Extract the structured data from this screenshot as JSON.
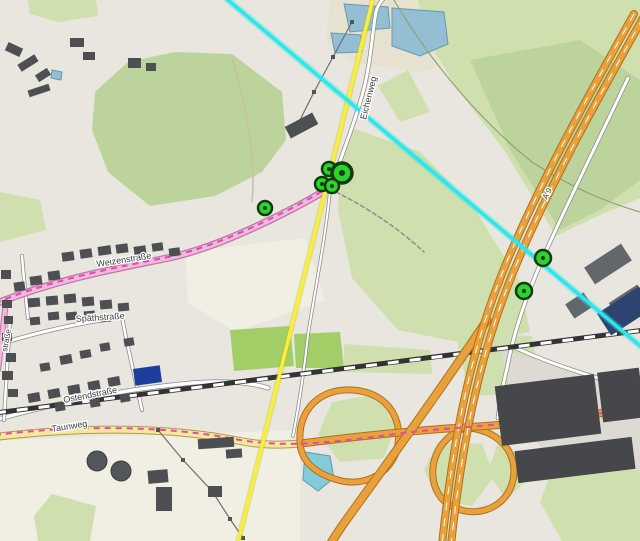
{
  "map": {
    "width": 640,
    "height": 541,
    "colors": {
      "background": "#e8e6df",
      "pale_field": "#f1eee4",
      "forest": "#bcd49c",
      "grass": "#cfe0ae",
      "pitch": "#a3cd66",
      "sand": "#e7e1d0",
      "yard": "#dcdad2",
      "water": "#93bed3",
      "water_stroke": "#6899ad",
      "teal_pond": "#83cbd8",
      "building": "#4d4f52",
      "building_ind": "#63666b",
      "building_navy": "#2e4370",
      "building_pnavy": "#1d3e9c",
      "building_wh": "#45474b",
      "tank": "#53575b",
      "road_white": "#ffffff",
      "road_casing": "#8a8a86",
      "road_pink": "#f2b8dd",
      "road_pink_casing": "#b7799f",
      "road_yellow": "#f4e99b",
      "road_yellow_casing": "#b09a4e",
      "road_orange": "#e9a23b",
      "road_orange_casing": "#b06f1e",
      "rail_dark": "#333333",
      "rail_dash": "#ffffff",
      "route_magenta": "#e645b5",
      "overlay_yellow": "#f6ef3d",
      "overlay_cyan": "#2ee6e9",
      "marker_fill": "#2ed22e",
      "marker_ring": "#113c11",
      "power_line": "#6f6f6f",
      "boundary_green": "#8fa273"
    },
    "areas": [
      {
        "name": "sand-around-ponds",
        "fill": "sand",
        "points": "330,0 455,0 458,62 420,72 352,62 326,42"
      },
      {
        "name": "pale-field-1",
        "fill": "pale_field",
        "points": "185,252 305,238 325,300 235,332 188,302"
      },
      {
        "name": "pale-field-2",
        "fill": "pale_field",
        "points": "0,440 300,430 300,541 0,541"
      },
      {
        "name": "green-top-left",
        "fill": "grass",
        "points": "28,0 96,0 98,16 58,22 30,14"
      },
      {
        "name": "forest-left",
        "fill": "forest",
        "points": "95,92 128,62 175,52 232,54 282,92 286,140 262,172 215,196 150,206 108,172 92,130"
      },
      {
        "name": "green-right-top",
        "fill": "grass",
        "points": "418,0 640,0 640,198 598,216 556,236 504,150 455,86 428,40"
      },
      {
        "name": "forest-right",
        "fill": "forest",
        "points": "470,60 580,40 640,80 640,180 600,210 560,230 510,150"
      },
      {
        "name": "green-meadow-mid",
        "fill": "grass",
        "points": "352,128 420,152 472,205 520,282 530,332 468,344 398,330 352,278 338,210 342,160"
      },
      {
        "name": "green-mid-right-low",
        "fill": "grass",
        "points": "455,334 532,336 542,392 470,396"
      },
      {
        "name": "green-left-mid",
        "fill": "grass",
        "points": "0,192 40,200 46,230 0,242"
      },
      {
        "name": "green-bottom-left",
        "fill": "grass",
        "points": "52,494 96,506 90,541 38,541 34,516"
      },
      {
        "name": "green-bottom-right",
        "fill": "grass",
        "points": "552,470 640,458 640,541 562,541 540,502"
      },
      {
        "name": "yard-se",
        "fill": "yard",
        "points": "500,350 640,388 640,470 560,470 518,420"
      },
      {
        "name": "pitch-1",
        "fill": "pitch",
        "points": "230,330 290,326 294,366 234,371"
      },
      {
        "name": "pitch-2",
        "fill": "pitch",
        "points": "294,334 340,332 344,368 296,368"
      },
      {
        "name": "green-strip",
        "fill": "grass",
        "points": "344,344 430,350 432,374 344,372"
      },
      {
        "name": "green-interchange-1",
        "fill": "grass",
        "points": "332,402 378,394 396,424 384,458 340,462 318,434"
      },
      {
        "name": "green-interchange-2",
        "fill": "grass",
        "points": "438,442 482,444 494,476 472,506 438,500 424,470"
      },
      {
        "name": "green-interchange-3",
        "fill": "grass",
        "points": "498,442 540,468 506,500 488,472"
      },
      {
        "name": "green-small-top",
        "fill": "grass",
        "points": "378,86 408,70 430,112 400,122"
      },
      {
        "name": "pond-1",
        "fill": "water",
        "stroke": "water_stroke",
        "points": "392,8 444,12 448,44 420,56 392,46"
      },
      {
        "name": "pond-2",
        "fill": "water",
        "stroke": "water_stroke",
        "points": "344,4 388,7 390,28 350,32"
      },
      {
        "name": "pond-3",
        "fill": "water",
        "stroke": "water_stroke",
        "points": "331,33 361,35 362,52 335,53"
      },
      {
        "name": "pond-teal",
        "fill": "teal_pond",
        "stroke": "water_stroke",
        "points": "305,452 330,456 334,478 318,491 303,480"
      },
      {
        "name": "pond-top-left",
        "fill": "water",
        "stroke": "water_stroke",
        "points": "52,70 62,72 61,80 51,78"
      }
    ],
    "roads_base": [
      {
        "name": "forest-boundary",
        "d": "M 394,0 C 430,62 482,122 532,162 C 572,188 606,202 640,212",
        "w": 1.2,
        "color": "boundary_green"
      },
      {
        "name": "forest-track",
        "d": "M 232,58 C 248,112 256,160 252,202",
        "w": 1.5,
        "color": "#c9bfa4"
      },
      {
        "name": "street-spaeth",
        "d": "M 0,344 C 45,330 85,322 122,317",
        "w": 3,
        "color": "road_white",
        "cw": 4.5,
        "cc": "road_casing"
      },
      {
        "name": "street-cross-1",
        "d": "M 22,256 C 24,280 26,300 28,318",
        "w": 2.5,
        "color": "road_white",
        "cw": 4,
        "cc": "road_casing"
      },
      {
        "name": "street-cross-2",
        "d": "M 122,317 C 128,350 136,382 142,410",
        "w": 2.5,
        "color": "road_white",
        "cw": 4,
        "cc": "road_casing"
      },
      {
        "name": "street-ostend",
        "d": "M -5,420 C 60,402 120,390 182,384 C 220,380 250,382 268,388",
        "w": 3.5,
        "color": "road_white",
        "cw": 5,
        "cc": "road_casing"
      },
      {
        "name": "street-left-edge",
        "d": "M 10,318 C 8,352 6,386 4,420",
        "w": 2.5,
        "color": "road_white",
        "cw": 4,
        "cc": "road_casing"
      },
      {
        "name": "road-eichenweg",
        "d": "M 331,186 C 344,150 356,118 363,92 C 371,62 372,34 376,12 C 378,4 382,0 386,-4",
        "w": 3,
        "color": "road_white",
        "cw": 4.5,
        "cc": "road_casing"
      },
      {
        "name": "path-south-from-cluster",
        "d": "M 330,190 C 326,235 315,290 308,335 C 303,380 298,410 293,436",
        "w": 2,
        "color": "road_white",
        "cw": 3.5,
        "cc": "road_casing"
      },
      {
        "name": "path-dotted-se",
        "d": "M 336,192 C 368,208 398,228 424,252",
        "w": 1.5,
        "color": "#8f8f8f",
        "dash": "4 3"
      },
      {
        "name": "road-weizen-pink",
        "d": "M -5,304 C 60,278 120,268 168,258 C 225,246 300,206 331,187",
        "w": 5,
        "color": "road_pink",
        "cw": 7.5,
        "cc": "road_pink_casing"
      },
      {
        "name": "road-pink-branch",
        "d": "M 6,302 C 3,326 1,348 -2,370",
        "w": 4,
        "color": "road_pink",
        "cw": 6,
        "cc": "road_pink_casing"
      },
      {
        "name": "road-taunweg-yellow",
        "d": "M -5,437 C 70,428 160,425 240,441 C 265,446 285,445 305,443",
        "w": 6,
        "color": "road_yellow",
        "cw": 8,
        "cc": "road_yellow_casing"
      },
      {
        "name": "service-road-se",
        "d": "M 516,348 C 560,368 602,380 645,390",
        "w": 3,
        "color": "road_white",
        "cw": 4.5,
        "cc": "road_casing"
      },
      {
        "name": "road-parallel-a9",
        "d": "M 628,78 C 594,150 562,214 543,258 C 527,294 514,330 507,368 C 502,388 500,402 498,418",
        "w": 3,
        "color": "road_white",
        "cw": 4.5,
        "cc": "road_casing"
      }
    ],
    "railway": {
      "d": "M -5,413 C 160,392 400,362 645,330",
      "base_w": 5,
      "dash_w": 3,
      "dash": "11 11"
    },
    "roads_major": [
      {
        "name": "ramp-loop-west",
        "d": "M 300,441 C 298,410 320,388 352,390 C 384,392 402,414 398,444 C 394,472 366,488 338,480 C 314,473 300,460 300,441 Z",
        "w": 5,
        "color": "road_orange",
        "cw": 7,
        "cc": "road_orange_casing"
      },
      {
        "name": "ramp-loop-east",
        "d": "M 470,428 C 502,432 520,456 512,484 C 504,510 472,520 448,504 C 428,490 428,458 446,440 C 453,433 460,428 470,428 Z",
        "w": 5,
        "color": "road_orange",
        "cw": 7,
        "cc": "road_orange_casing"
      },
      {
        "name": "road-ew-orange",
        "d": "M 305,443 C 360,436 420,430 470,427 C 520,424 560,420 640,407",
        "w": 6,
        "color": "road_orange",
        "cw": 8,
        "cc": "road_orange_casing"
      },
      {
        "name": "ramp-branch-sw",
        "d": "M 487,320 C 450,376 400,446 352,512 C 344,523 337,533 331,543",
        "w": 7,
        "color": "road_orange",
        "cw": 9,
        "cc": "road_orange_casing"
      },
      {
        "name": "motorway-a9-c1",
        "d": "M 634,14 C 588,96 530,200 498,284 C 468,362 452,448 442,545",
        "w": 6,
        "color": "road_orange",
        "cw": 8,
        "cc": "road_orange_casing"
      },
      {
        "name": "motorway-a9-c2",
        "d": "M 643,18 C 597,100 539,204 507,288 C 477,366 461,452 451,545",
        "w": 6,
        "color": "road_orange",
        "cw": 8,
        "cc": "road_orange_casing"
      },
      {
        "name": "motorway-a9-dash-1",
        "d": "M 634,14 C 588,96 530,200 498,284 C 468,362 452,448 442,545",
        "w": 1,
        "color": "#ffffff",
        "dash": "7 9"
      },
      {
        "name": "motorway-a9-dash-2",
        "d": "M 643,18 C 597,100 539,204 507,288 C 477,366 461,452 451,545",
        "w": 1,
        "color": "#ffffff",
        "dash": "7 9"
      }
    ],
    "route_overlay": [
      {
        "name": "route-magenta-south",
        "d": "M -5,435 C 70,426 160,424 240,440 C 300,450 360,438 420,431 C 480,426 560,420 645,407"
      },
      {
        "name": "route-magenta-north",
        "d": "M -5,303 C 60,277 120,267 168,257 C 225,245 300,205 331,186"
      }
    ],
    "power_lines": [
      {
        "name": "power-line-north",
        "points": [
          [
            352,
            22
          ],
          [
            333,
            57
          ],
          [
            314,
            92
          ],
          [
            298,
            124
          ]
        ]
      },
      {
        "name": "power-line-south",
        "points": [
          [
            158,
            430
          ],
          [
            183,
            460
          ],
          [
            212,
            491
          ],
          [
            230,
            519
          ],
          [
            243,
            538
          ]
        ]
      }
    ],
    "buildings": [
      [
        62,
        252,
        12,
        9,
        -8,
        "b"
      ],
      [
        80,
        249,
        12,
        9,
        -8,
        "b"
      ],
      [
        98,
        246,
        13,
        9,
        -8,
        "b"
      ],
      [
        116,
        244,
        12,
        9,
        -8,
        "b"
      ],
      [
        134,
        246,
        12,
        9,
        -8,
        "b"
      ],
      [
        152,
        243,
        11,
        8,
        -8,
        "b"
      ],
      [
        169,
        248,
        11,
        8,
        -8,
        "b"
      ],
      [
        30,
        276,
        12,
        9,
        -8,
        "b"
      ],
      [
        48,
        271,
        12,
        9,
        -8,
        "b"
      ],
      [
        14,
        282,
        11,
        9,
        -8,
        "b"
      ],
      [
        1,
        270,
        10,
        9,
        0,
        "b"
      ],
      [
        28,
        298,
        12,
        9,
        -5,
        "b"
      ],
      [
        46,
        296,
        12,
        9,
        -5,
        "b"
      ],
      [
        64,
        294,
        12,
        9,
        -5,
        "b"
      ],
      [
        82,
        297,
        12,
        9,
        -5,
        "b"
      ],
      [
        100,
        300,
        12,
        9,
        -5,
        "b"
      ],
      [
        118,
        303,
        11,
        8,
        -5,
        "b"
      ],
      [
        48,
        312,
        11,
        8,
        -5,
        "b"
      ],
      [
        66,
        312,
        11,
        8,
        -5,
        "b"
      ],
      [
        84,
        311,
        11,
        8,
        -5,
        "b"
      ],
      [
        100,
        314,
        11,
        8,
        -5,
        "b"
      ],
      [
        30,
        317,
        10,
        8,
        -5,
        "b"
      ],
      [
        2,
        300,
        10,
        8,
        0,
        "b"
      ],
      [
        4,
        316,
        9,
        8,
        0,
        "b"
      ],
      [
        2,
        333,
        10,
        8,
        0,
        "b"
      ],
      [
        6,
        353,
        10,
        9,
        0,
        "b"
      ],
      [
        2,
        371,
        11,
        9,
        0,
        "b"
      ],
      [
        8,
        389,
        10,
        8,
        0,
        "b"
      ],
      [
        60,
        355,
        12,
        9,
        -10,
        "b"
      ],
      [
        80,
        350,
        11,
        8,
        -10,
        "b"
      ],
      [
        40,
        363,
        10,
        8,
        -10,
        "b"
      ],
      [
        100,
        343,
        10,
        8,
        -10,
        "b"
      ],
      [
        124,
        338,
        10,
        8,
        -10,
        "b"
      ],
      [
        28,
        393,
        12,
        9,
        -10,
        "b"
      ],
      [
        48,
        389,
        12,
        9,
        -10,
        "b"
      ],
      [
        68,
        385,
        12,
        9,
        -10,
        "b"
      ],
      [
        88,
        381,
        12,
        9,
        -10,
        "b"
      ],
      [
        108,
        377,
        12,
        9,
        -10,
        "b"
      ],
      [
        55,
        403,
        10,
        8,
        -10,
        "b"
      ],
      [
        90,
        399,
        10,
        8,
        -10,
        "b"
      ],
      [
        120,
        394,
        10,
        8,
        -10,
        "b"
      ],
      [
        6,
        45,
        16,
        9,
        25,
        "b"
      ],
      [
        18,
        59,
        20,
        8,
        -32,
        "b"
      ],
      [
        36,
        71,
        14,
        8,
        -32,
        "b"
      ],
      [
        70,
        38,
        14,
        9,
        0,
        "b"
      ],
      [
        83,
        52,
        12,
        8,
        0,
        "b"
      ],
      [
        28,
        87,
        22,
        7,
        -18,
        "b"
      ],
      [
        128,
        58,
        13,
        10,
        0,
        "b"
      ],
      [
        146,
        63,
        10,
        8,
        0,
        "b"
      ],
      [
        286,
        119,
        31,
        13,
        -28,
        "b"
      ],
      [
        198,
        438,
        36,
        10,
        -4,
        "b"
      ],
      [
        226,
        449,
        16,
        9,
        -4,
        "b"
      ],
      [
        148,
        470,
        20,
        13,
        -5,
        "b"
      ],
      [
        156,
        487,
        16,
        24,
        0,
        "b"
      ],
      [
        208,
        486,
        14,
        11,
        0,
        "b"
      ],
      [
        586,
        254,
        44,
        20,
        -33,
        "ind"
      ],
      [
        612,
        292,
        34,
        22,
        -33,
        "ind"
      ],
      [
        568,
        297,
        22,
        17,
        -33,
        "ind"
      ],
      [
        600,
        298,
        50,
        26,
        -33,
        "navy"
      ],
      [
        498,
        380,
        100,
        60,
        -7,
        "wh"
      ],
      [
        600,
        370,
        42,
        50,
        -7,
        "wh"
      ],
      [
        516,
        444,
        118,
        32,
        -7,
        "wh"
      ],
      [
        134,
        367,
        27,
        17,
        -8,
        "pnavy"
      ]
    ],
    "tanks": [
      {
        "name": "storage-tank-1",
        "cx": 97,
        "cy": 461,
        "r": 10
      },
      {
        "name": "storage-tank-2",
        "cx": 121,
        "cy": 471,
        "r": 10
      }
    ],
    "overlay_lines": [
      {
        "name": "overlay-line-yellow",
        "x1": 374,
        "y1": -5,
        "x2": 237,
        "y2": 546,
        "color": "overlay_yellow",
        "w": 3.5,
        "glow": "rgba(200,185,0,0.35)",
        "gw": 6
      },
      {
        "name": "overlay-line-cyan",
        "x1": 222,
        "y1": -5,
        "x2": 645,
        "y2": 350,
        "color": "overlay_cyan",
        "w": 3.5,
        "glow": "rgba(46,230,233,0.35)",
        "gw": 7
      }
    ],
    "labels": [
      {
        "id": "label-weizenstrasse",
        "text": "Weizenstraße",
        "x": 97,
        "y": 267,
        "rot": -9,
        "size": 9
      },
      {
        "id": "label-spaethstrasse",
        "text": "Späthstraße",
        "x": 76,
        "y": 322,
        "rot": -4,
        "size": 9
      },
      {
        "id": "label-ostendstrasse",
        "text": "Ostendstraße",
        "x": 64,
        "y": 403,
        "rot": -11,
        "size": 9
      },
      {
        "id": "label-taunweg",
        "text": "Taunweg",
        "x": 52,
        "y": 432,
        "rot": -9,
        "size": 9
      },
      {
        "id": "label-eichenweg",
        "text": "Eichenweg",
        "x": 366,
        "y": 120,
        "rot": -76,
        "size": 9
      },
      {
        "id": "label-a9",
        "text": "A 9",
        "x": 547,
        "y": 200,
        "rot": -64,
        "size": 8
      },
      {
        "id": "label-street-partial",
        "text": "straße",
        "x": 7,
        "y": 352,
        "rot": -80,
        "size": 8
      }
    ],
    "markers": [
      {
        "x": 329,
        "y": 169,
        "r": 7
      },
      {
        "x": 342,
        "y": 173,
        "r": 10
      },
      {
        "x": 322,
        "y": 184,
        "r": 7
      },
      {
        "x": 332,
        "y": 186,
        "r": 7
      },
      {
        "x": 265,
        "y": 208,
        "r": 7
      },
      {
        "x": 543,
        "y": 258,
        "r": 8
      },
      {
        "x": 524,
        "y": 291,
        "r": 8
      }
    ]
  }
}
